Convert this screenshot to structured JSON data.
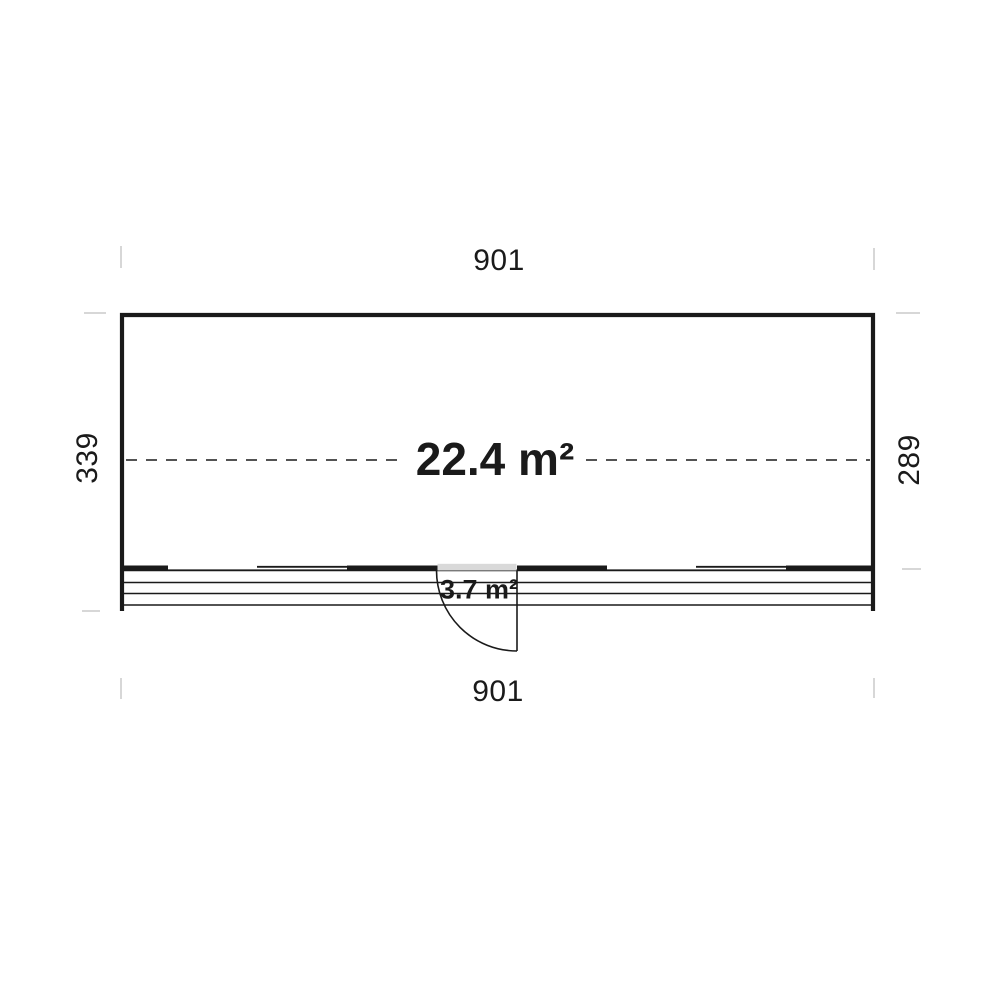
{
  "plan": {
    "type": "floor-plan",
    "labels": {
      "width_top": "901",
      "width_bottom": "901",
      "height_left": "339",
      "height_right": "289",
      "main_area": "22.4 m²",
      "terrace_area": "3.7 m²"
    },
    "colors": {
      "line": "#1a1a1a",
      "tick": "#d7d7d7",
      "door_fill": "#d9d9d9",
      "bg": "#ffffff"
    }
  }
}
